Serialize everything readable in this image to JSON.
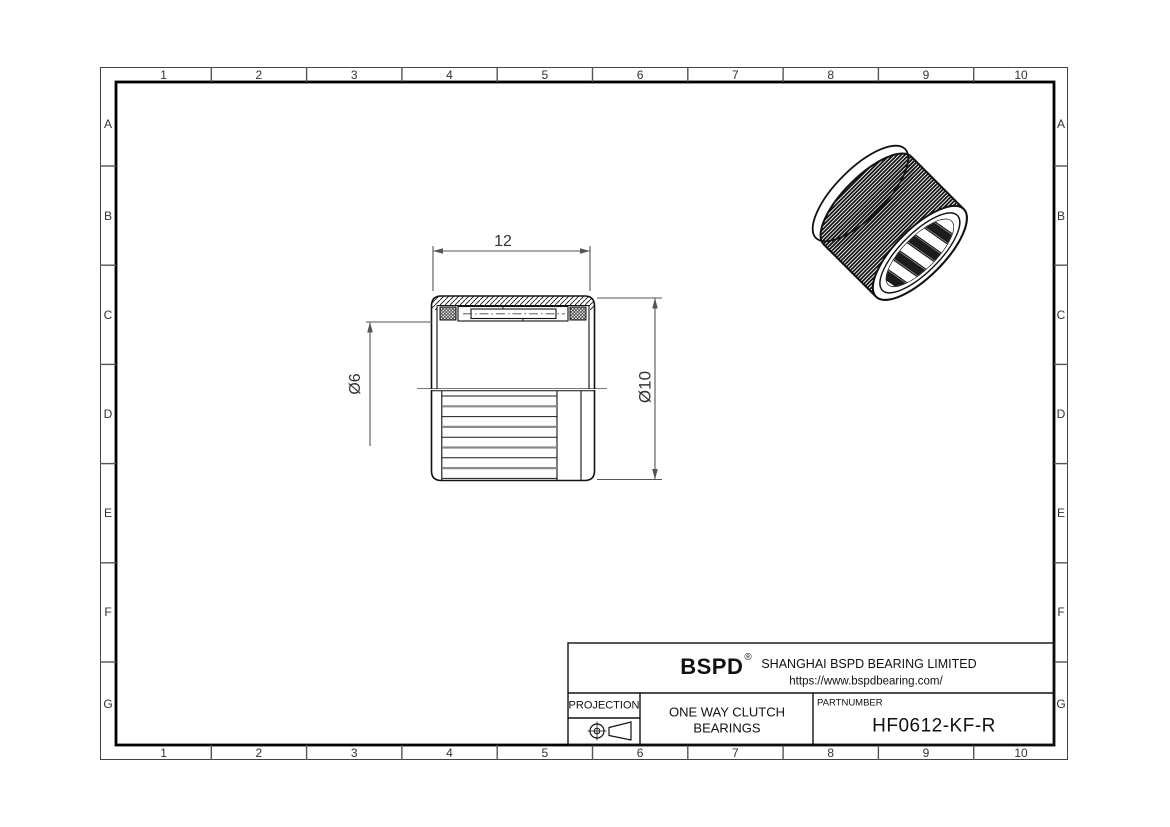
{
  "grid": {
    "columns": [
      "1",
      "2",
      "3",
      "4",
      "5",
      "6",
      "7",
      "8",
      "9",
      "10"
    ],
    "rows": [
      "A",
      "B",
      "C",
      "D",
      "E",
      "F",
      "G"
    ]
  },
  "drawing": {
    "dim_width": "12",
    "dim_bore": "Ø6",
    "dim_outer": "Ø10"
  },
  "title_block": {
    "brand": "BSPD",
    "registered_mark": "®",
    "company": "SHANGHAI BSPD BEARING LIMITED",
    "website": "https://www.bspdbearing.com/",
    "projection_label": "PROJECTION",
    "product_line1": "ONE WAY CLUTCH",
    "product_line2": "BEARINGS",
    "part_number_label": "PARTNUMBER",
    "part_number": "HF0612-KF-R"
  }
}
